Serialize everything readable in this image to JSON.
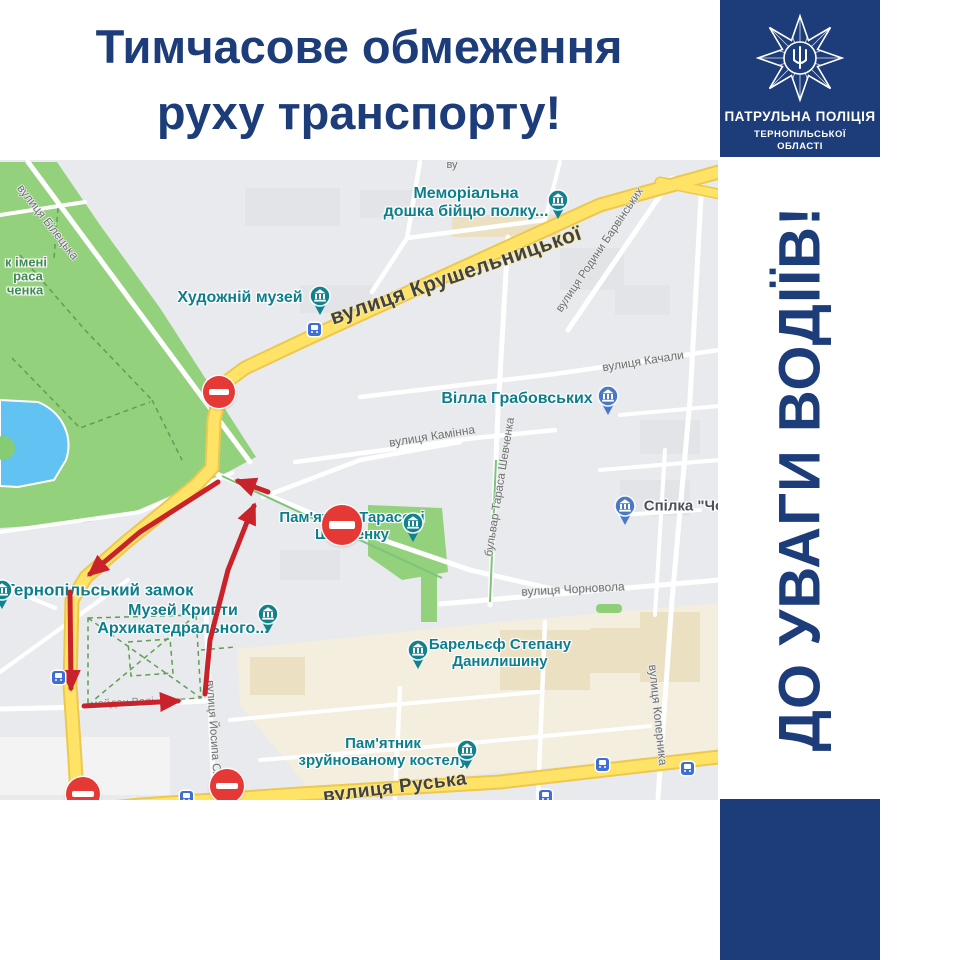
{
  "header": {
    "line1": "Тимчасове обмеження",
    "line2": "руху транспорту!"
  },
  "sidebar": {
    "badge": {
      "line1": "ПАТРУЛЬНА ПОЛІЦІЯ",
      "line2": "ТЕРНОПІЛЬСЬКОЇ",
      "line3": "ОБЛАСТІ"
    },
    "vertical_text": "ДО УВАГИ ВОДІЇВ!"
  },
  "colors": {
    "navy": "#1d3c7a",
    "route_red": "#c8232b",
    "sign_red": "#e53935",
    "poi_teal": "#0c7e8c",
    "pin_teal": "#12818e",
    "pin_blue": "#4a79c4",
    "park_green": "#93d17c",
    "water_blue": "#62c3f2",
    "road_yellow": "#ffe366"
  },
  "map": {
    "pois": [
      {
        "lines": [
          "Меморіальна",
          "дошка бійцю полку..."
        ],
        "x": 466,
        "y": 43,
        "size": 16,
        "color": "teal",
        "pin": {
          "x": 558,
          "y": 40,
          "color": "teal"
        }
      },
      {
        "lines": [
          "Художній музей"
        ],
        "x": 240,
        "y": 138,
        "size": 16,
        "color": "teal",
        "pin": {
          "x": 320,
          "y": 136,
          "color": "teal"
        }
      },
      {
        "lines": [
          "Вілла Грабовських"
        ],
        "x": 517,
        "y": 239,
        "size": 16,
        "color": "teal",
        "pin": {
          "x": 608,
          "y": 236,
          "color": "blue"
        }
      },
      {
        "lines": [
          "Спілка \"Чо"
        ],
        "x": 684,
        "y": 347,
        "size": 15,
        "color": "dark",
        "pin": {
          "x": 625,
          "y": 346,
          "color": "blue"
        }
      },
      {
        "lines": [
          "Пам'ятник Тарасові",
          "Шевченку"
        ],
        "x": 352,
        "y": 367,
        "size": 15,
        "color": "teal",
        "pin": {
          "x": 413,
          "y": 363,
          "color": "teal"
        }
      },
      {
        "lines": [
          "Тернопільський замок"
        ],
        "x": 99,
        "y": 430,
        "size": 17,
        "color": "teal",
        "pin": {
          "x": 2,
          "y": 430,
          "color": "teal"
        }
      },
      {
        "lines": [
          "Музей Крипти",
          "Архикатедрального..."
        ],
        "x": 183,
        "y": 460,
        "size": 16,
        "color": "teal",
        "pin": {
          "x": 268,
          "y": 454,
          "color": "teal"
        }
      },
      {
        "lines": [
          "Барельєф Степану",
          "Данилишину"
        ],
        "x": 500,
        "y": 494,
        "size": 15,
        "color": "teal",
        "pin": {
          "x": 418,
          "y": 490,
          "color": "teal"
        }
      },
      {
        "lines": [
          "Пам'ятник",
          "зруйнованому костелу"
        ],
        "x": 383,
        "y": 593,
        "size": 15,
        "color": "teal",
        "pin": {
          "x": 467,
          "y": 590,
          "color": "teal"
        }
      }
    ],
    "streets": [
      {
        "text": "ву",
        "x": 452,
        "y": 5,
        "rot": 0,
        "size": 11,
        "style": ""
      },
      {
        "text": "вулиця Білецька",
        "x": 48,
        "y": 62,
        "rot": 52,
        "size": 12,
        "style": ""
      },
      {
        "text": "вулиця Крушельницької",
        "x": 456,
        "y": 116,
        "rot": -19,
        "size": 21,
        "style": "major"
      },
      {
        "text": "вулиця Родини Барвінських",
        "x": 600,
        "y": 90,
        "rot": -56,
        "size": 11.5,
        "style": ""
      },
      {
        "text": "вулиця Качали",
        "x": 643,
        "y": 201,
        "rot": -9,
        "size": 12,
        "style": ""
      },
      {
        "text": "вулиця Камінна",
        "x": 432,
        "y": 276,
        "rot": -9,
        "size": 12,
        "style": ""
      },
      {
        "text": "бульвар Тараса Шевченка",
        "x": 500,
        "y": 327,
        "rot": -81,
        "size": 11.5,
        "style": ""
      },
      {
        "text": "вулиця Чорновола",
        "x": 573,
        "y": 429,
        "rot": -3,
        "size": 12,
        "style": ""
      },
      {
        "text": "майдан Волі",
        "x": 122,
        "y": 543,
        "rot": -3,
        "size": 11,
        "style": "faint"
      },
      {
        "text": "вулиця Йосипа Сліпого",
        "x": 214,
        "y": 582,
        "rot": 86,
        "size": 11.5,
        "style": ""
      },
      {
        "text": "вулиця Коперника",
        "x": 658,
        "y": 555,
        "rot": 84,
        "size": 12,
        "style": ""
      },
      {
        "text": "вулиця Руська",
        "x": 395,
        "y": 628,
        "rot": -7,
        "size": 19,
        "style": "major"
      }
    ],
    "park_label": [
      {
        "text": "к імені",
        "x": 26,
        "y": 103
      },
      {
        "text": "раса",
        "x": 28,
        "y": 117
      },
      {
        "text": "ченка",
        "x": 25,
        "y": 131
      }
    ],
    "transit": [
      [
        314,
        169
      ],
      [
        58,
        517
      ],
      [
        186,
        637
      ],
      [
        545,
        636
      ],
      [
        602,
        604
      ],
      [
        687,
        608
      ]
    ],
    "no_entry": [
      {
        "x": 219,
        "y": 232,
        "r": 16
      },
      {
        "x": 342,
        "y": 365,
        "r": 20
      },
      {
        "x": 83,
        "y": 634,
        "r": 17
      },
      {
        "x": 227,
        "y": 626,
        "r": 17
      }
    ],
    "route": [
      {
        "points": [
          [
            218,
            322
          ],
          [
            140,
            372
          ],
          [
            90,
            414
          ]
        ]
      },
      {
        "points": [
          [
            70,
            432
          ],
          [
            71,
            528
          ]
        ]
      },
      {
        "points": [
          [
            84,
            546
          ],
          [
            178,
            541
          ]
        ]
      },
      {
        "points": [
          [
            205,
            534
          ],
          [
            210,
            480
          ],
          [
            228,
            410
          ],
          [
            247,
            362
          ],
          [
            254,
            346
          ]
        ]
      },
      {
        "points": [
          [
            268,
            332
          ],
          [
            238,
            321
          ]
        ]
      }
    ]
  }
}
